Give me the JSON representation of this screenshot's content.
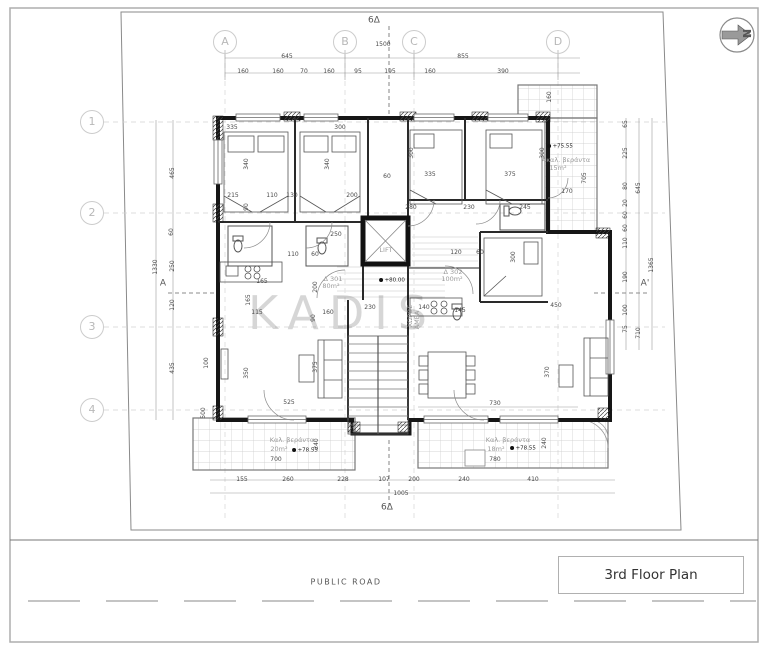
{
  "sheet": {
    "title": "3rd Floor Plan",
    "road_label": "PUBLIC ROAD",
    "watermark": "KADIS",
    "north_label": "N"
  },
  "units": [
    {
      "id": "Δ 301",
      "area": "80m²"
    },
    {
      "id": "Δ 302",
      "area": "100m²"
    }
  ],
  "grid": {
    "columns": [
      {
        "label": "A",
        "x": 225
      },
      {
        "label": "B",
        "x": 345
      },
      {
        "label": "C",
        "x": 414
      },
      {
        "label": "D",
        "x": 558
      }
    ],
    "rows": [
      {
        "label": "1",
        "y": 122
      },
      {
        "label": "2",
        "y": 213
      },
      {
        "label": "3",
        "y": 327
      },
      {
        "label": "4",
        "y": 410
      }
    ]
  },
  "plan": {
    "labels": [
      {
        "t": "645",
        "x": 287,
        "y": 57
      },
      {
        "t": "855",
        "x": 463,
        "y": 57
      },
      {
        "t": "160",
        "x": 243,
        "y": 72
      },
      {
        "t": "160",
        "x": 278,
        "y": 72
      },
      {
        "t": "70",
        "x": 304,
        "y": 72
      },
      {
        "t": "160",
        "x": 329,
        "y": 72
      },
      {
        "t": "95",
        "x": 358,
        "y": 72
      },
      {
        "t": "195",
        "x": 390,
        "y": 72
      },
      {
        "t": "160",
        "x": 430,
        "y": 72
      },
      {
        "t": "390",
        "x": 503,
        "y": 72
      },
      {
        "t": "1500",
        "x": 383,
        "y": 45
      },
      {
        "t": "6Δ",
        "x": 374,
        "y": 21,
        "c": "s"
      },
      {
        "t": "160",
        "x": 550,
        "y": 97,
        "r": 1
      },
      {
        "t": "335",
        "x": 232,
        "y": 128
      },
      {
        "t": "300",
        "x": 340,
        "y": 128
      },
      {
        "t": "340",
        "x": 247,
        "y": 164,
        "r": 1
      },
      {
        "t": "340",
        "x": 328,
        "y": 164,
        "r": 1
      },
      {
        "t": "300",
        "x": 412,
        "y": 153,
        "r": 1
      },
      {
        "t": "300",
        "x": 543,
        "y": 153,
        "r": 1
      },
      {
        "t": "335",
        "x": 430,
        "y": 175
      },
      {
        "t": "375",
        "x": 510,
        "y": 175
      },
      {
        "t": "60",
        "x": 387,
        "y": 177
      },
      {
        "t": "215",
        "x": 233,
        "y": 196
      },
      {
        "t": "110",
        "x": 272,
        "y": 196
      },
      {
        "t": "130",
        "x": 292,
        "y": 196
      },
      {
        "t": "200",
        "x": 352,
        "y": 196
      },
      {
        "t": "90",
        "x": 247,
        "y": 207,
        "r": 1
      },
      {
        "t": "250",
        "x": 336,
        "y": 235
      },
      {
        "t": "280",
        "x": 411,
        "y": 208
      },
      {
        "t": "230",
        "x": 469,
        "y": 208
      },
      {
        "t": "245",
        "x": 525,
        "y": 208
      },
      {
        "t": "170",
        "x": 567,
        "y": 192
      },
      {
        "t": "705",
        "x": 585,
        "y": 178,
        "r": 1
      },
      {
        "t": "+75.55",
        "x": 560,
        "y": 147,
        "c": "l"
      },
      {
        "t": "Ακαλ. βεράντα",
        "x": 566,
        "y": 160,
        "c": "r"
      },
      {
        "t": "15m²",
        "x": 558,
        "y": 168,
        "c": "r"
      },
      {
        "t": "LIFT",
        "x": 386,
        "y": 250,
        "c": "r"
      },
      {
        "t": "120",
        "x": 456,
        "y": 253
      },
      {
        "t": "60",
        "x": 480,
        "y": 253
      },
      {
        "t": "Δ 301",
        "x": 333,
        "y": 279,
        "c": "r"
      },
      {
        "t": "80m²",
        "x": 331,
        "y": 286,
        "c": "r"
      },
      {
        "t": "Δ 302",
        "x": 453,
        "y": 272,
        "c": "r"
      },
      {
        "t": "100m²",
        "x": 452,
        "y": 279,
        "c": "r"
      },
      {
        "t": "+80.00",
        "x": 392,
        "y": 281,
        "c": "l"
      },
      {
        "t": "ΧΩΡΟΣ",
        "x": 410,
        "y": 316,
        "r": 1,
        "c": "r"
      },
      {
        "t": "ΑΜΕΑ",
        "x": 417,
        "y": 320,
        "r": 1,
        "c": "r"
      },
      {
        "t": "140",
        "x": 424,
        "y": 308
      },
      {
        "t": "145",
        "x": 460,
        "y": 311
      },
      {
        "t": "230",
        "x": 370,
        "y": 308
      },
      {
        "t": "160",
        "x": 328,
        "y": 313
      },
      {
        "t": "90",
        "x": 314,
        "y": 318,
        "r": 1
      },
      {
        "t": "115",
        "x": 257,
        "y": 313
      },
      {
        "t": "165",
        "x": 262,
        "y": 282
      },
      {
        "t": "165",
        "x": 249,
        "y": 300,
        "r": 1
      },
      {
        "t": "200",
        "x": 316,
        "y": 287,
        "r": 1
      },
      {
        "t": "110",
        "x": 293,
        "y": 255
      },
      {
        "t": "60",
        "x": 315,
        "y": 255
      },
      {
        "t": "350",
        "x": 247,
        "y": 373,
        "r": 1
      },
      {
        "t": "375",
        "x": 316,
        "y": 367,
        "r": 1
      },
      {
        "t": "525",
        "x": 289,
        "y": 403
      },
      {
        "t": "100",
        "x": 207,
        "y": 363,
        "r": 1
      },
      {
        "t": "500",
        "x": 204,
        "y": 413,
        "r": 1
      },
      {
        "t": "435",
        "x": 173,
        "y": 368,
        "r": 1
      },
      {
        "t": "450",
        "x": 556,
        "y": 306
      },
      {
        "t": "300",
        "x": 514,
        "y": 257,
        "r": 1
      },
      {
        "t": "370",
        "x": 548,
        "y": 372,
        "r": 1
      },
      {
        "t": "730",
        "x": 495,
        "y": 404
      },
      {
        "t": "780",
        "x": 495,
        "y": 460
      },
      {
        "t": "Καλ. βεράντα",
        "x": 292,
        "y": 440,
        "c": "r"
      },
      {
        "t": "20m²",
        "x": 279,
        "y": 449,
        "c": "r"
      },
      {
        "t": "+78.55",
        "x": 305,
        "y": 451,
        "c": "l"
      },
      {
        "t": "240",
        "x": 317,
        "y": 444,
        "r": 1
      },
      {
        "t": "700",
        "x": 276,
        "y": 460
      },
      {
        "t": "Καλ. βεράντα",
        "x": 508,
        "y": 440,
        "c": "r"
      },
      {
        "t": "18m²",
        "x": 496,
        "y": 449,
        "c": "r"
      },
      {
        "t": "+78.55",
        "x": 523,
        "y": 449,
        "c": "l"
      },
      {
        "t": "240",
        "x": 545,
        "y": 443,
        "r": 1
      },
      {
        "t": "155",
        "x": 242,
        "y": 480
      },
      {
        "t": "260",
        "x": 288,
        "y": 480
      },
      {
        "t": "228",
        "x": 343,
        "y": 480
      },
      {
        "t": "107",
        "x": 384,
        "y": 480
      },
      {
        "t": "200",
        "x": 414,
        "y": 480
      },
      {
        "t": "240",
        "x": 464,
        "y": 480
      },
      {
        "t": "410",
        "x": 533,
        "y": 480
      },
      {
        "t": "1005",
        "x": 401,
        "y": 494
      },
      {
        "t": "6Δ",
        "x": 387,
        "y": 508,
        "c": "s"
      },
      {
        "t": "465",
        "x": 173,
        "y": 173,
        "r": 1
      },
      {
        "t": "60",
        "x": 172,
        "y": 232,
        "r": 1
      },
      {
        "t": "250",
        "x": 173,
        "y": 266,
        "r": 1
      },
      {
        "t": "120",
        "x": 173,
        "y": 305,
        "r": 1
      },
      {
        "t": "1330",
        "x": 156,
        "y": 267,
        "r": 1
      },
      {
        "t": "A",
        "x": 163,
        "y": 284,
        "c": "s"
      },
      {
        "t": "65",
        "x": 626,
        "y": 124,
        "r": 1
      },
      {
        "t": "225",
        "x": 626,
        "y": 153,
        "r": 1
      },
      {
        "t": "80",
        "x": 626,
        "y": 186,
        "r": 1
      },
      {
        "t": "20",
        "x": 626,
        "y": 203,
        "r": 1
      },
      {
        "t": "60",
        "x": 626,
        "y": 215,
        "r": 1
      },
      {
        "t": "60",
        "x": 626,
        "y": 228,
        "r": 1
      },
      {
        "t": "110",
        "x": 626,
        "y": 243,
        "r": 1
      },
      {
        "t": "190",
        "x": 626,
        "y": 277,
        "r": 1
      },
      {
        "t": "100",
        "x": 626,
        "y": 310,
        "r": 1
      },
      {
        "t": "75",
        "x": 626,
        "y": 329,
        "r": 1
      },
      {
        "t": "645",
        "x": 639,
        "y": 188,
        "r": 1
      },
      {
        "t": "1365",
        "x": 652,
        "y": 265,
        "r": 1
      },
      {
        "t": "710",
        "x": 639,
        "y": 333,
        "r": 1
      },
      {
        "t": "A'",
        "x": 645,
        "y": 284,
        "c": "s"
      }
    ]
  }
}
